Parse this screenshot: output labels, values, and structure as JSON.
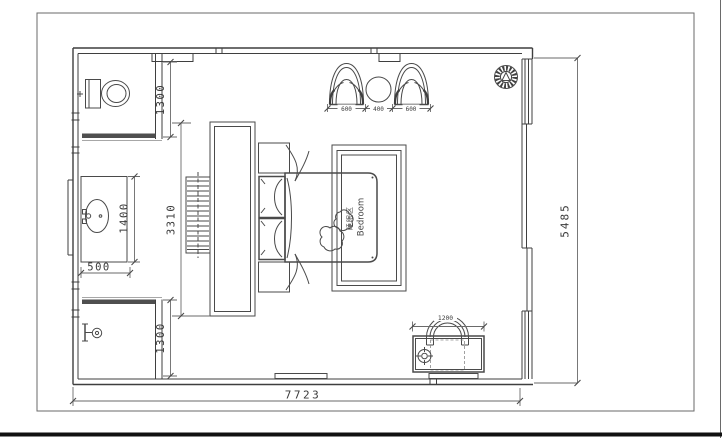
{
  "plan": {
    "room_label": {
      "cn": "睡眠区",
      "en": "Bedroom"
    },
    "dimensions": {
      "toilet_room_depth": "1300",
      "vanity_length": "1400",
      "vanity_width": "500",
      "tv_wall_length": "3310",
      "shower_room_depth": "1300",
      "armchair_left_width": "600",
      "side_table_width": "400",
      "armchair_right_width": "600",
      "desk_width": "1200",
      "room_depth_right": "5485",
      "room_width_bottom": "7723"
    },
    "symbols": [
      "toilet-symbol",
      "wash-basin-symbol",
      "shower-symbol",
      "radiator-symbol",
      "tv-cabinet",
      "double-bed-symbol",
      "nightstand-symbol",
      "rug-outline",
      "armchair-symbol",
      "side-table-symbol",
      "potted-plant-symbol",
      "desk-symbol",
      "desk-chair-symbol",
      "table-lamp-symbol"
    ],
    "colors": {
      "line": "#4a4a4a",
      "wall": "#3f3f3f",
      "dim_text": "#3a3a3a",
      "threshold_fill": "#4f4f4f",
      "sheet_edge": "#111111",
      "background": "#ffffff"
    }
  }
}
